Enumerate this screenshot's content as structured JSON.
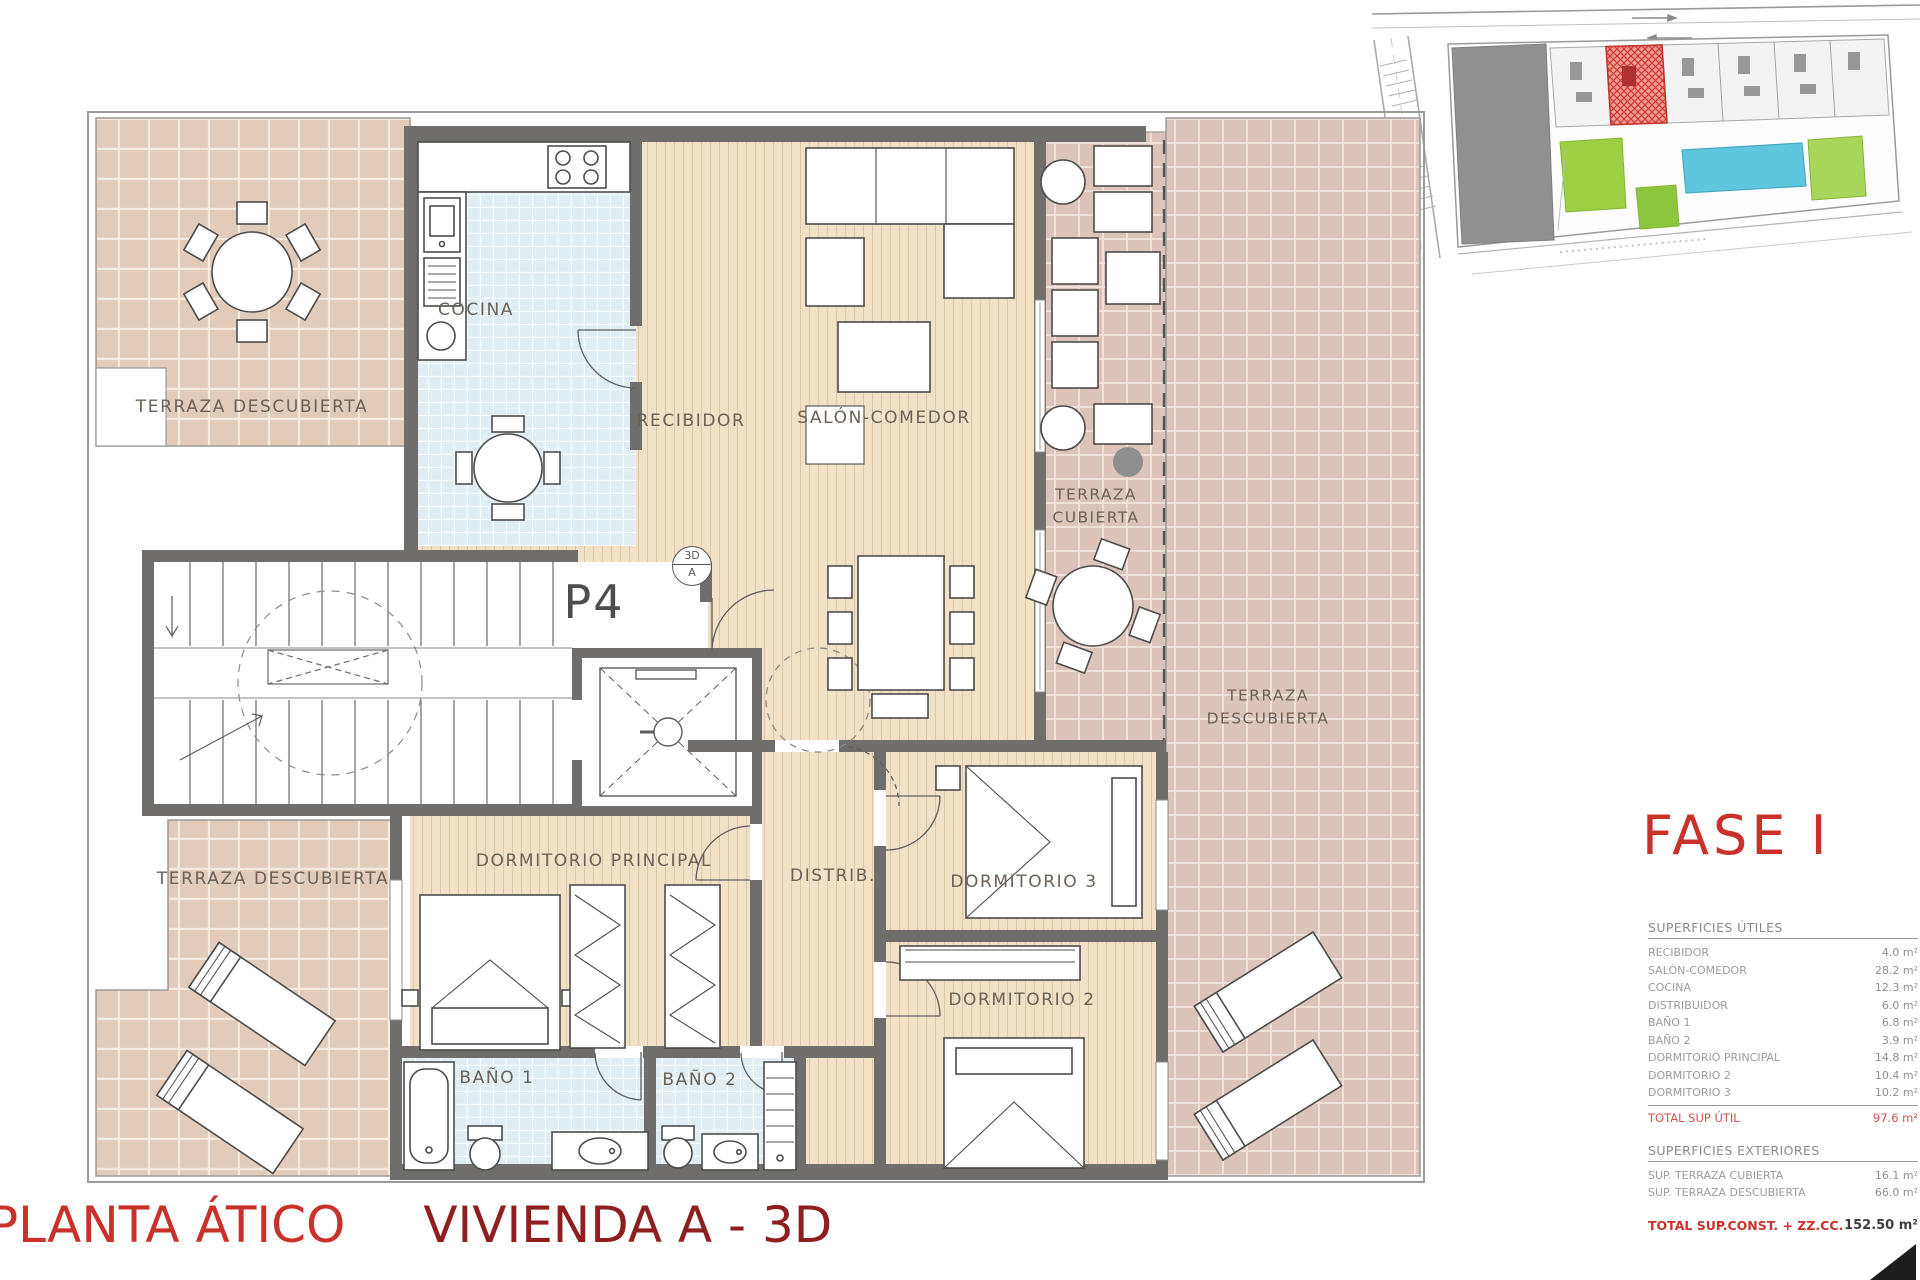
{
  "floor_plan": {
    "unit_label": "P4",
    "stamp": {
      "top": "3D",
      "bottom": "A"
    },
    "rooms": {
      "terraza_descubierta_top": "TERRAZA DESCUBIERTA",
      "cocina": "COCINA",
      "recibidor": "RECIBIDOR",
      "salon_comedor": "SALÓN-COMEDOR",
      "terraza_cubierta": [
        "TERRAZA",
        "CUBIERTA"
      ],
      "terraza_descubierta_right": [
        "TERRAZA",
        "DESCUBIERTA"
      ],
      "dormitorio_principal": "DORMITORIO PRINCIPAL",
      "distribuidor": "DISTRIB.",
      "dormitorio_3": "DORMITORIO 3",
      "dormitorio_2": "DORMITORIO 2",
      "bano_1": "BAÑO 1",
      "bano_2": "BAÑO 2",
      "terraza_descubierta_bottom": "TERRAZA DESCUBIERTA"
    }
  },
  "phase": {
    "label": "FASE I"
  },
  "surfaces_utiles": {
    "header": "SUPERFICIES ÚTILES",
    "rows": [
      {
        "label": "RECIBIDOR",
        "value": "4.0 m²"
      },
      {
        "label": "SALÓN-COMEDOR",
        "value": "28.2 m²"
      },
      {
        "label": "COCINA",
        "value": "12.3 m²"
      },
      {
        "label": "DISTRIBUIDOR",
        "value": "6.0 m²"
      },
      {
        "label": "BAÑO 1",
        "value": "6.8 m²"
      },
      {
        "label": "BAÑO 2",
        "value": "3.9 m²"
      },
      {
        "label": "DORMITORIO PRINCIPAL",
        "value": "14.8 m²"
      },
      {
        "label": "DORMITORIO 2",
        "value": "10.4 m²"
      },
      {
        "label": "DORMITORIO 3",
        "value": "10.2 m²"
      }
    ],
    "total": {
      "label": "TOTAL SUP ÚTIL",
      "value": "97.6 m²"
    }
  },
  "surfaces_exteriores": {
    "header": "SUPERFICIES EXTERIORES",
    "rows": [
      {
        "label": "SUP. TERRAZA CUBIERTA",
        "value": "16.1 m²"
      },
      {
        "label": "SUP. TERRAZA DESCUBIERTA",
        "value": "66.0 m²"
      }
    ]
  },
  "grand_total": {
    "label": "TOTAL SUP.CONST. + ZZ.CC.",
    "value": "152.50 m²"
  },
  "title": {
    "part1": "PLANTA ÁTICO",
    "part2": "VIVIENDA A - 3D"
  },
  "colors": {
    "accent_red": "#c9322b",
    "dark_red": "#8f1e1e",
    "wall_gray": "#6f6e6c",
    "tile_beige": "#e2cbb9",
    "tile_pink": "#dcc4ba",
    "tile_blue": "#e0edf2",
    "wood": "#f1e1c6",
    "highlight_unit_red": "#cf3a32",
    "pool_blue": "#5fc6e0",
    "garden_green": "#9ccf44"
  }
}
